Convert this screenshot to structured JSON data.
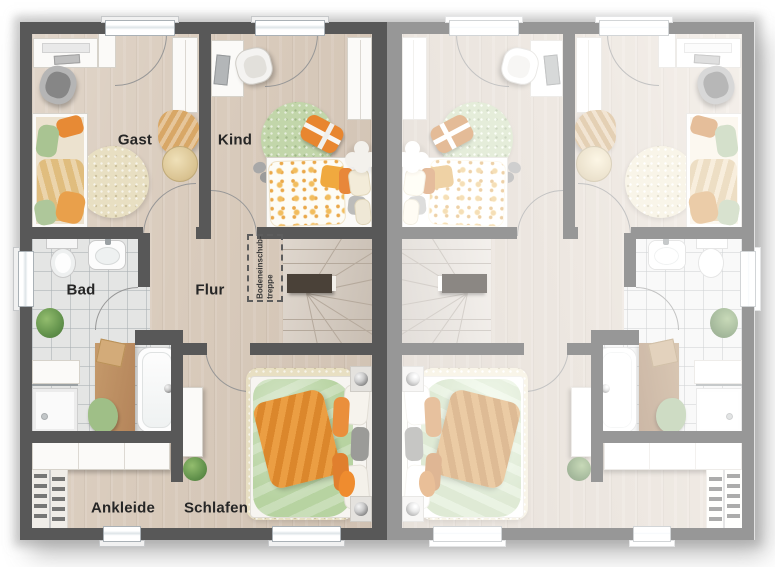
{
  "floorplan": {
    "title": "Obergeschoss Doppelhaus Grundriss",
    "unit_left": {
      "rooms": {
        "gast": {
          "label": "Gast"
        },
        "kind": {
          "label": "Kind"
        },
        "bad": {
          "label": "Bad"
        },
        "flur": {
          "label": "Flur"
        },
        "ankleide": {
          "label": "Ankleide"
        },
        "schlafen": {
          "label": "Schlafen"
        }
      },
      "loft_hatch": {
        "line1": "Bodeneinschub-",
        "line2": "treppe"
      }
    },
    "unit_right": {
      "mirrored": true,
      "labels_visible": false
    },
    "colors": {
      "wall": "#585858",
      "wall_faded": "#9a9a9a",
      "floor_wood": "#d9cbbc",
      "tile": "#e4e5e4",
      "accent_orange": "#e8873a",
      "accent_green": "#b7d3a1",
      "rug_beige": "#e8dfc2",
      "rug_green": "#c2d6aa",
      "furniture_wood": "#bf9465",
      "furniture_white": "#fbfaf8"
    }
  }
}
